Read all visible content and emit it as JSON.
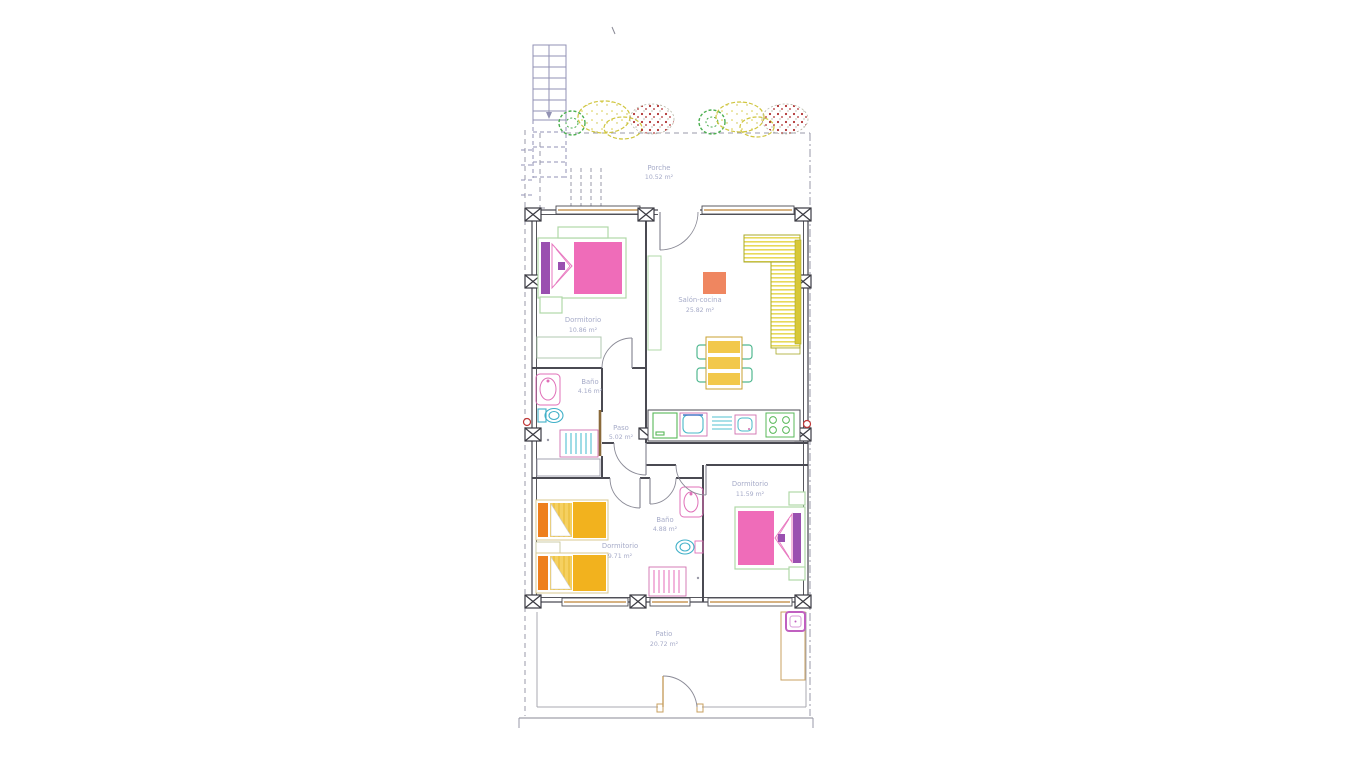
{
  "plan_title": "floor plan",
  "rooms": [
    {
      "id": "porche",
      "name": "Porche",
      "area": "10.52 m²"
    },
    {
      "id": "dormitorio1",
      "name": "Dormitorio",
      "area": "10.86 m²"
    },
    {
      "id": "salon",
      "name": "Salón-cocina",
      "area": "25.82 m²"
    },
    {
      "id": "bano1",
      "name": "Baño",
      "area": "4.16 m²"
    },
    {
      "id": "paso",
      "name": "Paso",
      "area": "5.02 m²"
    },
    {
      "id": "dormitorio2",
      "name": "Dormitorio",
      "area": "11.59 m²"
    },
    {
      "id": "bano2",
      "name": "Baño",
      "area": "4.88 m²"
    },
    {
      "id": "dormitorio3",
      "name": "Dormitorio",
      "area": "9.71 m²"
    },
    {
      "id": "patio",
      "name": "Patio",
      "area": "20.72 m²"
    }
  ],
  "palette": {
    "wall": "#44444c",
    "label": "#a6abc8",
    "bed_pink": "#ef6cb9",
    "headboard_purple": "#9a50b0",
    "bed_frame_green": "#b0d8a8",
    "bed_orange": "#f2b21e",
    "headboard_orange": "#ee7f1d",
    "pillow_yellow": "#f5d060",
    "sofa_yellow": "#e8da5a",
    "table_amber": "#f2c84b",
    "chair_green": "#50b890",
    "rug_salmon": "#ef8660",
    "fixture_magenta": "#e070b8",
    "fixture_cyan": "#40b0c8",
    "appliance_green": "#58b858",
    "sill_tan": "#c89858",
    "stair_purple": "#9292b4",
    "bush_green": "#4caf50",
    "bush_yellow": "#cfc53e",
    "berry_red": "#b03030",
    "patio_tan": "#c8a060",
    "boundary_gray": "#9a9aa8",
    "valve_red": "#c03838",
    "door_wood": "#8a6a3a"
  }
}
